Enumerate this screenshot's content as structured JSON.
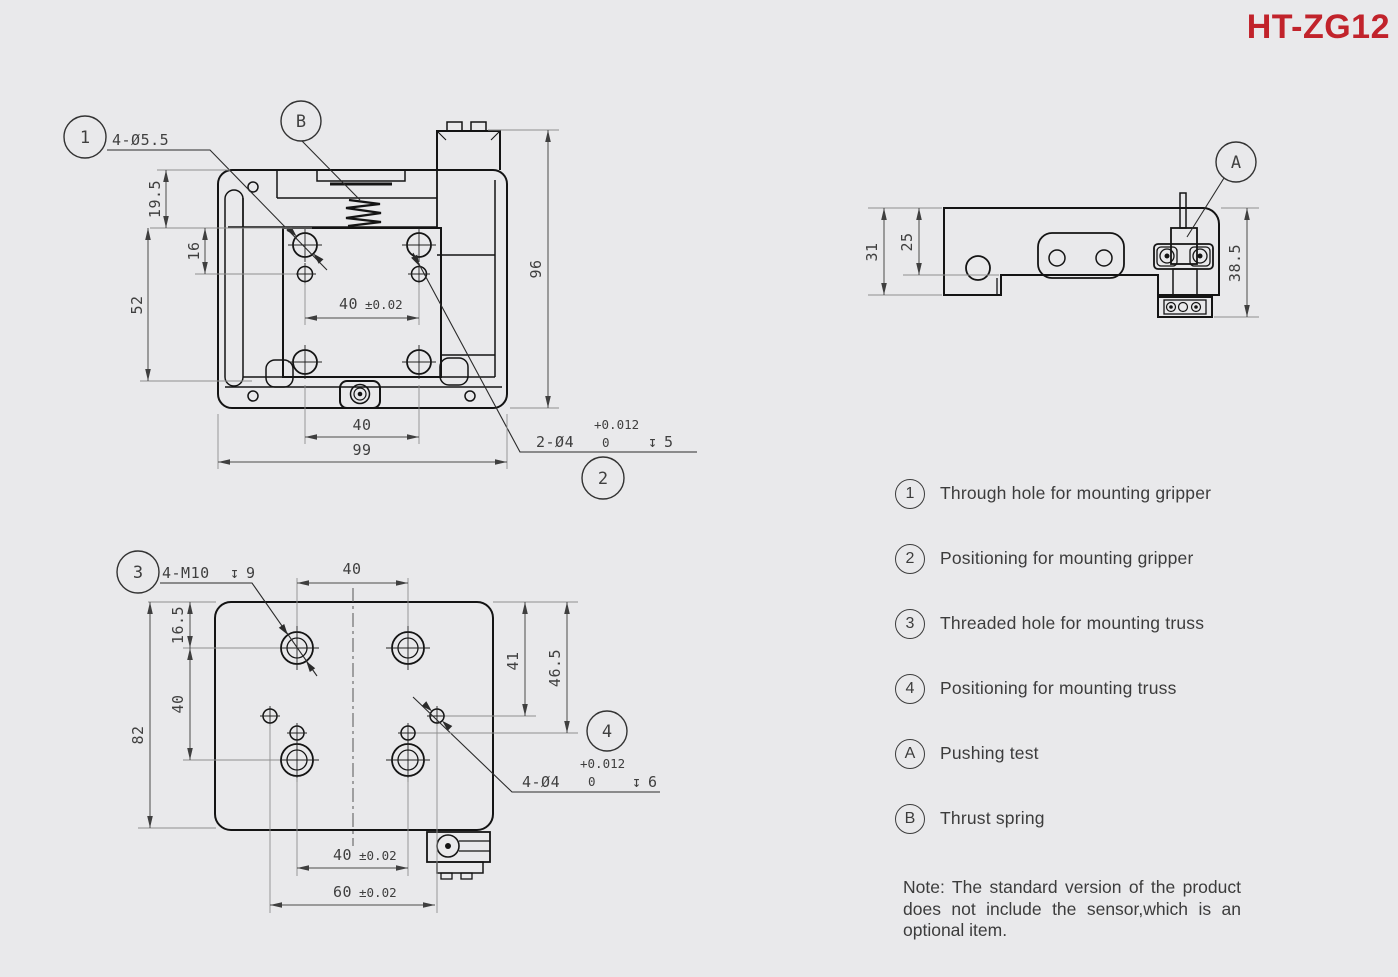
{
  "title": "HT-ZG12",
  "colors": {
    "title_red": "#C1232B",
    "background": "#E9E9EB",
    "outline": "#141414",
    "dimension": "#4a4a4a"
  },
  "front_view": {
    "callout_1": "1",
    "callout_2": "2",
    "callout_b": "B",
    "label_through_holes": "4-Ø5.5",
    "pos_label": "2-Ø4",
    "pos_tol_plus": "+0.012",
    "pos_tol_zero": "0",
    "pos_depth_symbol": "↧",
    "pos_depth": "5",
    "dim_19_5": "19.5",
    "dim_16": "16",
    "dim_52": "52",
    "dim_40_center": "40",
    "dim_40_center_tol": "±0.02",
    "dim_40_bottom": "40",
    "dim_99": "99",
    "dim_96": "96"
  },
  "side_view": {
    "callout_a": "A",
    "dim_31": "31",
    "dim_25": "25",
    "dim_38_5": "38.5"
  },
  "bottom_view": {
    "callout_3": "3",
    "callout_4": "4",
    "thread_label": "4-M10",
    "thread_depth_symbol": "↧",
    "thread_depth": "9",
    "pos_label": "4-Ø4",
    "pos_tol_plus": "+0.012",
    "pos_tol_zero": "0",
    "pos_depth_symbol": "↧",
    "pos_depth": "6",
    "dim_16_5": "16.5",
    "dim_40_left": "40",
    "dim_82": "82",
    "dim_40_top": "40",
    "dim_41": "41",
    "dim_46_5": "46.5",
    "dim_40_bottom": "40",
    "dim_40_bottom_tol": "±0.02",
    "dim_60": "60",
    "dim_60_tol": "±0.02"
  },
  "legend": {
    "items": [
      {
        "symbol": "1",
        "label": "Through hole for mounting gripper"
      },
      {
        "symbol": "2",
        "label": "Positioning for mounting gripper"
      },
      {
        "symbol": "3",
        "label": "Threaded hole for mounting truss"
      },
      {
        "symbol": "4",
        "label": "Positioning for mounting truss"
      },
      {
        "symbol": "A",
        "label": "Pushing test"
      },
      {
        "symbol": "B",
        "label": "Thrust spring"
      }
    ]
  },
  "note": "Note: The standard version of the product does not include the sensor,which is an optional item."
}
